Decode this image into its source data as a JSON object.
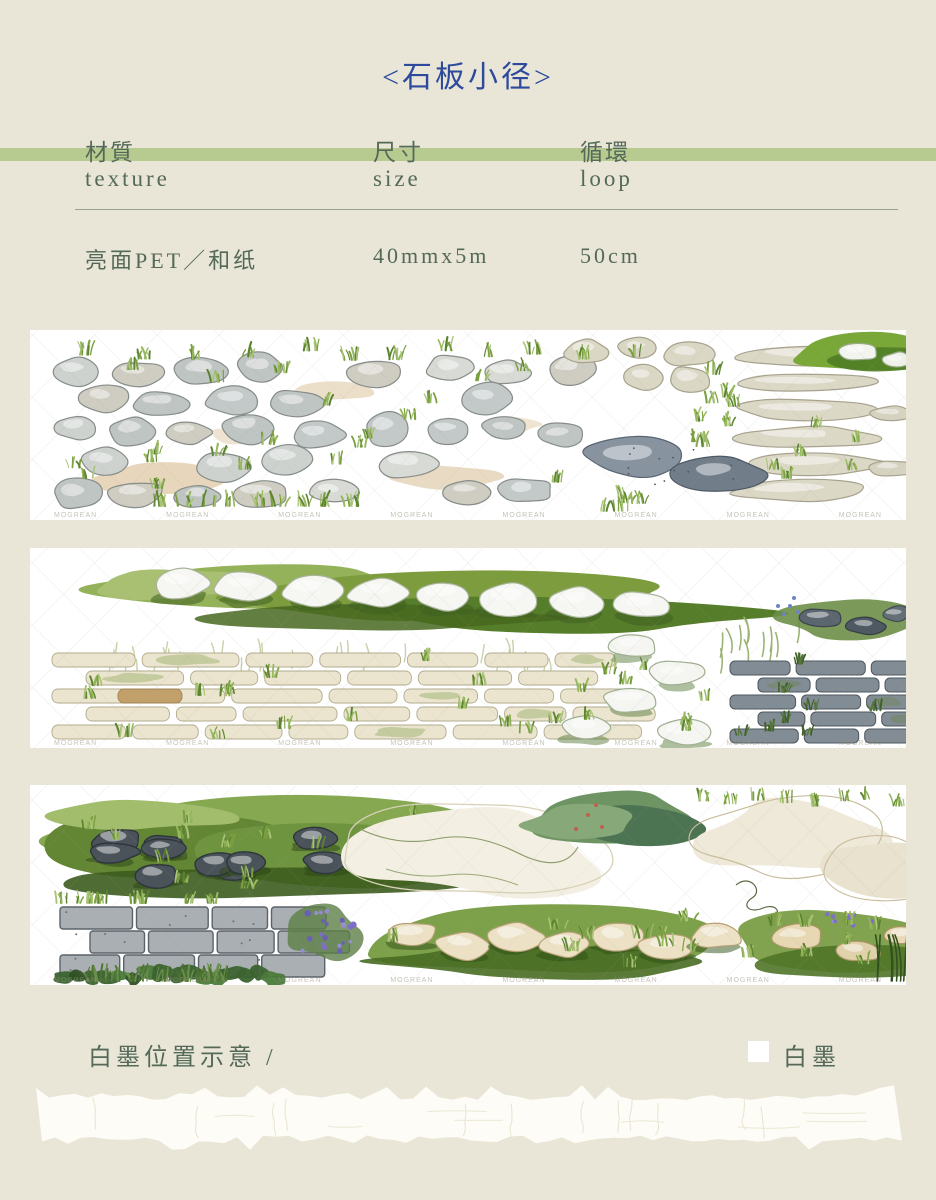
{
  "title": {
    "text": "<石板小径>"
  },
  "colors": {
    "bg": "#e9e6d7",
    "title": "#2d4a9d",
    "text": "#546957",
    "accent": "#b7ca90",
    "divider": "#9aa190",
    "swatch": "#ffffff"
  },
  "spec": {
    "columns": [
      {
        "zh": "材質",
        "en": "texture",
        "value": "亮面PET／和纸"
      },
      {
        "zh": "尺寸",
        "en": "size",
        "value": "40mmx5m"
      },
      {
        "zh": "循環",
        "en": "loop",
        "value": "50cm"
      }
    ]
  },
  "strips": [
    {
      "art": "watercolor cobblestone field with grass tufts, slab rows at right"
    },
    {
      "art": "stepping stones in grass band, cream brick path, dark slab path at right"
    },
    {
      "art": "dark stones on grass mat, stone wall with violets, sandy clearing, beige stepping stones"
    }
  ],
  "watermark": {
    "text": "MOGREAN"
  },
  "white_ink": {
    "heading": "白墨位置示意 /",
    "label": "白墨"
  }
}
